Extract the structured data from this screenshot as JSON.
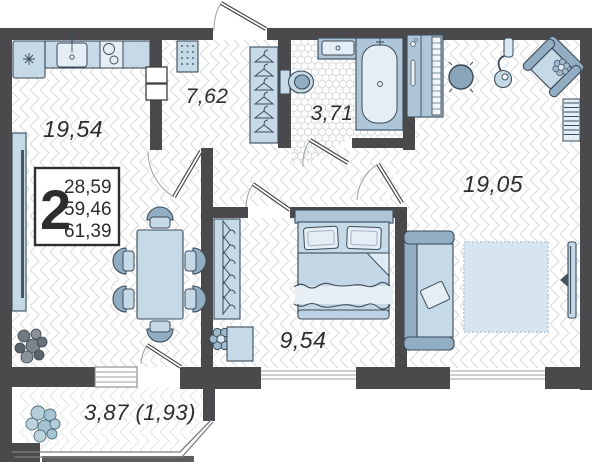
{
  "summary": {
    "room_count": "2",
    "value1": "28,59",
    "value2": "59,46",
    "value3": "61,39"
  },
  "rooms": {
    "kitchen_dining": {
      "area": "19,54"
    },
    "hallway": {
      "area": "7,62"
    },
    "bathroom": {
      "area": "3,71"
    },
    "living_room": {
      "area": "19,05"
    },
    "bedroom": {
      "area": "9,54"
    },
    "balcony": {
      "area": "3,87 (1,93)"
    }
  },
  "colors": {
    "wall": "#4a4a4c",
    "furniture": "#c6d9e7",
    "furniture_mid": "#93aec3",
    "furniture_light": "#e6eef5",
    "outline": "#3b4b59",
    "text": "#2d2d2d"
  }
}
